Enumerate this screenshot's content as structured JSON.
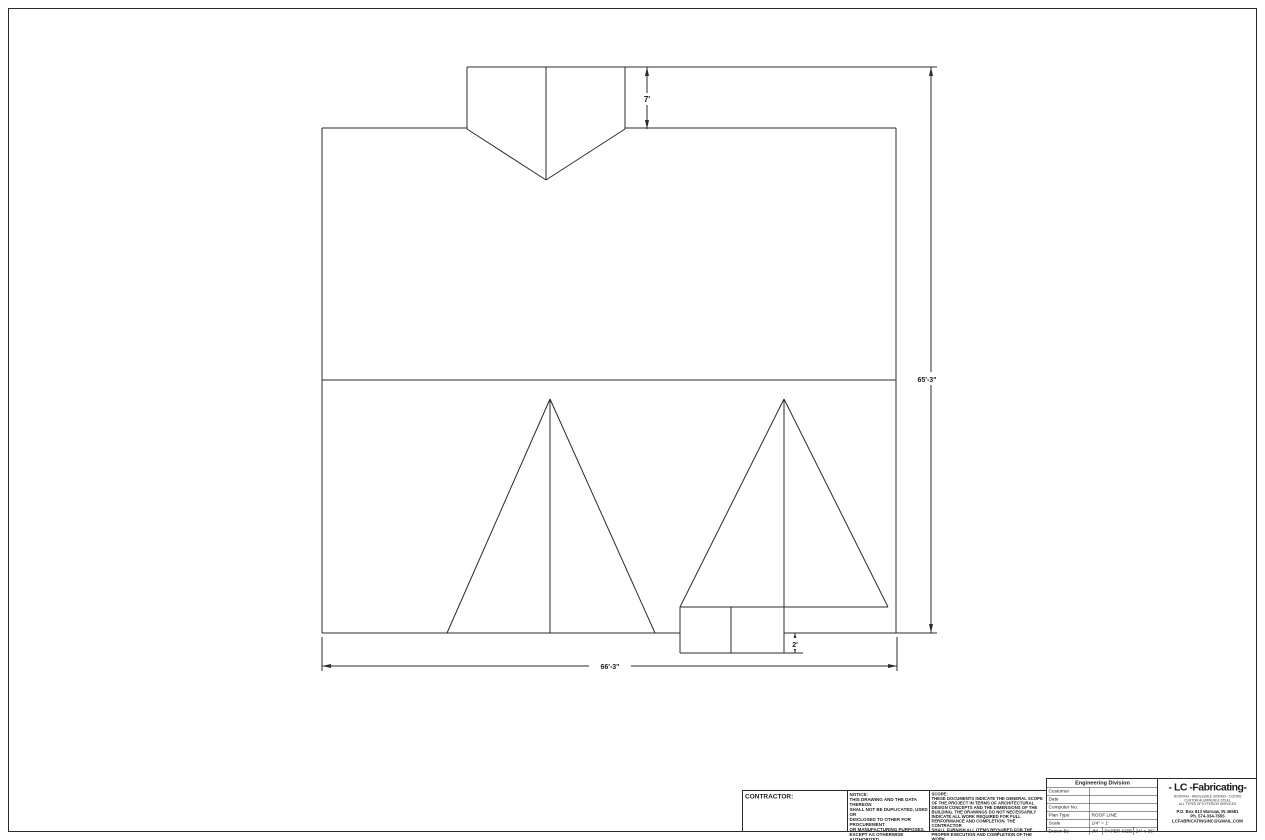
{
  "dimensions": {
    "overall_width": "66'-3\"",
    "overall_height": "65'-3\"",
    "dormer_height": "7'",
    "porch_depth": "2'"
  },
  "title_block": {
    "contractor_label": "CONTRACTOR:",
    "notice": {
      "heading": "NOTICE:",
      "lines": [
        "THIS DRAWING AND THE DATA THEREON",
        "SHALL NOT BE DUPLICATED, USED OR",
        "DISCLOSED TO OTHER FOR PROCUREMENT",
        "OR MANUFACTURING PURPOSES,",
        "EXCEPT AS OTHERWISE AUTHORIZED",
        "BY CONTRACT, WITHOUT THE WRITTEN",
        "PERMISSION OF LC FABRICATING, INC."
      ]
    },
    "scope": {
      "heading": "SCOPE:",
      "lines": [
        "THESE DOCUMENTS INDICATE THE GENERAL SCOPE",
        "OF THE PROJECT IN TERMS OF ARCHITECTURAL",
        "DESIGN CONCEPTS AND THE DIMENSIONS OF THE",
        "BUILDING. THE DRAWINGS DO NOT NECESSARILY",
        "INDICATE ALL WORK REQUIRED FOR FULL",
        "PERFORMANCE AND COMPLETION. THE CONTRACTOR",
        "SHALL FURNISH ALL ITEMS REQUIRED FOR THE",
        "PROPER EXECUTION AND COMPLETION OF THE WORK."
      ]
    },
    "engineering": {
      "header": "Engineering Division",
      "rows": [
        {
          "label": "Customer",
          "value": ""
        },
        {
          "label": "Date",
          "value": ""
        },
        {
          "label": "Computer No.",
          "value": ""
        },
        {
          "label": "Plan Type",
          "value": "ROOF LINE"
        },
        {
          "label": "Scale",
          "value": "1/4\" = 1'"
        }
      ],
      "drawn_by_label": "Drawn By",
      "drawn_by_value": "JM",
      "paper_size_label": "PAPER SIZE",
      "paper_size_value": "24\" x 36\""
    },
    "company": {
      "logo": "- LC -Fabricating-",
      "services_lines": [
        "ROOFING - WHOLESALE SIDINGS - DOORS",
        "CUSTOM ALUMINUM & STEEL",
        "ALL TYPES OF EXTERIOR SERVICES"
      ],
      "address": "P.O. Box 813 Warsaw, IN 46581",
      "phone": "Ph. 574-334-7655",
      "email": "LCFABRICATINGINC@GMAIL.COM"
    }
  }
}
